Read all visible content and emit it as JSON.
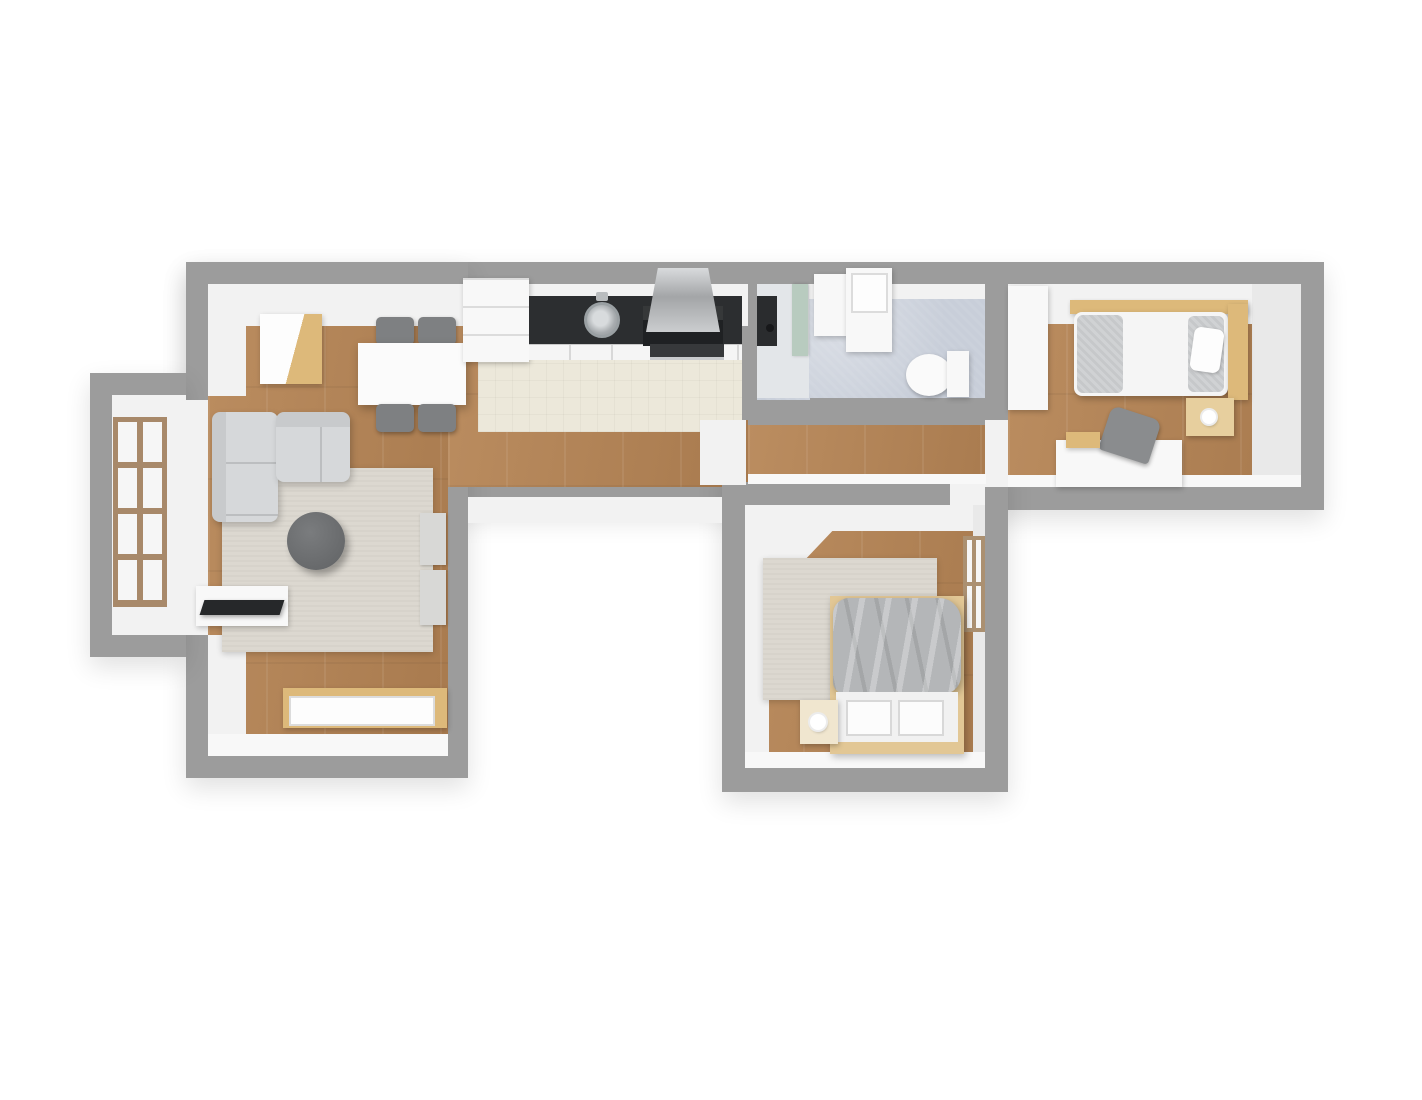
{
  "scene": {
    "description": "3D rendered top-down floor plan of an apartment, no visible text",
    "background": "#ffffff"
  },
  "palette": {
    "wall": "#9c9c9c",
    "wall_face": "#f2f2f2",
    "wood_floor": "#b08256",
    "kitchen_tile": "#ece8da",
    "bathroom_tile": "#c8ced9",
    "rug": "#dcd8d0",
    "sofa": "#d6d8da",
    "accent_wood": "#ddb97a",
    "counter_black": "#2c2e30",
    "blanket_gray": "#b4b6b8"
  },
  "rooms": [
    "living-room",
    "kitchen",
    "bathroom",
    "bedroom-right",
    "bedroom-bottom",
    "balcony-niche",
    "hallway"
  ],
  "elements": [
    {
      "n": "wall-main-bar",
      "c": "wallsh",
      "x": 186,
      "y": 262,
      "w": 1138,
      "h": 248
    },
    {
      "n": "wall-left-wing",
      "c": "wallsh",
      "x": 186,
      "y": 262,
      "w": 282,
      "h": 516
    },
    {
      "n": "wall-balcony-bay",
      "c": "wallsh",
      "x": 90,
      "y": 373,
      "w": 96,
      "h": 284
    },
    {
      "n": "wall-bottom-wing",
      "c": "wallsh",
      "x": 722,
      "y": 460,
      "w": 286,
      "h": 332
    },
    {
      "n": "balcony-floor",
      "c": "face",
      "x": 112,
      "y": 395,
      "w": 74,
      "h": 240
    },
    {
      "n": "balcony-opening",
      "c": "face",
      "x": 186,
      "y": 400,
      "w": 22,
      "h": 235
    },
    {
      "n": "living-room-floor",
      "c": "wood",
      "x": 208,
      "y": 284,
      "w": 240,
      "h": 472
    },
    {
      "n": "living-bar-floor",
      "c": "wood",
      "x": 448,
      "y": 284,
      "w": 300,
      "h": 203
    },
    {
      "n": "hallway-floor",
      "c": "wood",
      "x": 748,
      "y": 425,
      "w": 260,
      "h": 62
    },
    {
      "n": "bedroom-right-floor",
      "c": "wood",
      "x": 1008,
      "y": 284,
      "w": 293,
      "h": 203
    },
    {
      "n": "kitchen-floor",
      "c": "tcream",
      "x": 478,
      "y": 358,
      "w": 264,
      "h": 74
    },
    {
      "n": "bathroom-floor",
      "c": "tbath",
      "x": 757,
      "y": 284,
      "w": 228,
      "h": 116
    },
    {
      "n": "bedroom-bottom-floor",
      "c": "wood",
      "x": 745,
      "y": 505,
      "w": 240,
      "h": 263
    },
    {
      "n": "wall-kitchen-bathroom",
      "c": "wall",
      "x": 742,
      "y": 262,
      "w": 15,
      "h": 158
    },
    {
      "n": "wall-bathroom-bottom",
      "c": "wall",
      "x": 810,
      "y": 398,
      "w": 175,
      "h": 22
    },
    {
      "n": "wall-bathroom-bedroom",
      "c": "wall",
      "x": 985,
      "y": 262,
      "w": 23,
      "h": 140
    },
    {
      "n": "wall-bedroom-bottom-top",
      "c": "wall",
      "x": 722,
      "y": 482,
      "w": 234,
      "h": 23
    },
    {
      "n": "door-bedroom-right",
      "c": "face",
      "x": 985,
      "y": 420,
      "w": 23,
      "h": 67
    },
    {
      "n": "door-bedroom-bottom",
      "c": "face",
      "x": 950,
      "y": 482,
      "w": 35,
      "h": 25
    },
    {
      "n": "door-entry",
      "c": "face",
      "x": 700,
      "y": 420,
      "w": 46,
      "h": 65
    },
    {
      "n": "wallface-top-living-kitchen",
      "c": "face",
      "x": 208,
      "y": 284,
      "w": 540,
      "h": 42
    },
    {
      "n": "wallface-left-living-upper",
      "c": "face",
      "x": 208,
      "y": 284,
      "w": 38,
      "h": 112
    },
    {
      "n": "wallface-left-living-lower",
      "c": "face",
      "x": 208,
      "y": 635,
      "w": 38,
      "h": 121
    },
    {
      "n": "wallface-bottom-living",
      "c": "faceb",
      "x": 208,
      "y": 734,
      "w": 240,
      "h": 22
    },
    {
      "n": "wallface-top-bathroom",
      "c": "face",
      "x": 757,
      "y": 284,
      "w": 228,
      "h": 15
    },
    {
      "n": "wallface-top-bedroom-right",
      "c": "face",
      "x": 1008,
      "y": 284,
      "w": 293,
      "h": 40
    },
    {
      "n": "wallface-right-bedroom-right",
      "c": "faced",
      "x": 1252,
      "y": 284,
      "w": 49,
      "h": 203
    },
    {
      "n": "wallface-bottom-bedroom-right",
      "c": "faceb",
      "x": 1008,
      "y": 475,
      "w": 293,
      "h": 12
    },
    {
      "n": "wallface-void-top",
      "c": "face",
      "x": 468,
      "y": 497,
      "w": 254,
      "h": 26
    },
    {
      "n": "wallface-hallway-bottom",
      "c": "faceb",
      "x": 748,
      "y": 474,
      "w": 238,
      "h": 10
    },
    {
      "n": "wallface-top-bedroom-bottom",
      "c": "face",
      "x": 745,
      "y": 505,
      "w": 240,
      "h": 26
    },
    {
      "n": "wallface-diagonal-bedroom-bottom",
      "c": "face",
      "x": 745,
      "y": 505,
      "w": 112,
      "h": 118,
      "s": "clip-path:polygon(0 0,100% 0,0 100%);"
    },
    {
      "n": "wallface-left-bedroom-bottom",
      "c": "face",
      "x": 745,
      "y": 505,
      "w": 24,
      "h": 263
    },
    {
      "n": "wallface-right-bedroom-bottom",
      "c": "faced",
      "x": 973,
      "y": 505,
      "w": 12,
      "h": 263
    },
    {
      "n": "wallface-bottom-bedroom-bottom",
      "c": "faceb",
      "x": 745,
      "y": 752,
      "w": 240,
      "h": 16
    },
    {
      "n": "living-window",
      "c": "window-grid",
      "x": 113,
      "y": 417,
      "w": 54,
      "h": 190
    },
    {
      "n": "bedroom-bottom-window",
      "c": "window-grid-v",
      "x": 963,
      "y": 536,
      "w": 22,
      "h": 96
    },
    {
      "n": "living-cabinet",
      "c": "tan",
      "x": 260,
      "y": 314,
      "w": 62,
      "h": 70,
      "s": "background:linear-gradient(105deg,#fdfdfd 0 55%,#ddb97a 55% 100%);"
    },
    {
      "n": "dining-chair-top-left",
      "c": "chair",
      "x": 376,
      "y": 317,
      "w": 38,
      "h": 28
    },
    {
      "n": "dining-chair-top-right",
      "c": "chair",
      "x": 418,
      "y": 317,
      "w": 38,
      "h": 28
    },
    {
      "n": "dining-table",
      "c": "twhite",
      "x": 358,
      "y": 343,
      "w": 108,
      "h": 62
    },
    {
      "n": "dining-chair-bottom-left",
      "c": "chair",
      "x": 376,
      "y": 404,
      "w": 38,
      "h": 28
    },
    {
      "n": "dining-chair-bottom-right",
      "c": "chair",
      "x": 418,
      "y": 404,
      "w": 38,
      "h": 28
    },
    {
      "n": "living-rug",
      "c": "rug",
      "x": 222,
      "y": 468,
      "w": 211,
      "h": 184
    },
    {
      "n": "sofa-chaise",
      "c": "sofa-v",
      "x": 212,
      "y": 412,
      "w": 66,
      "h": 110
    },
    {
      "n": "sofa-main",
      "c": "sofa-h",
      "x": 276,
      "y": 412,
      "w": 74,
      "h": 70
    },
    {
      "n": "coffee-table",
      "c": "ctable",
      "x": 287,
      "y": 512,
      "w": 58,
      "h": 58
    },
    {
      "n": "radiator-upper",
      "c": "radiator",
      "x": 420,
      "y": 513,
      "w": 26,
      "h": 52
    },
    {
      "n": "radiator-lower",
      "c": "radiator",
      "x": 420,
      "y": 570,
      "w": 26,
      "h": 55
    },
    {
      "n": "tv-stand",
      "c": "white",
      "x": 196,
      "y": 586,
      "w": 92,
      "h": 40
    },
    {
      "n": "tv-screen",
      "c": "tv",
      "x": 202,
      "y": 600,
      "w": 80,
      "h": 15,
      "s": "transform:skewX(-18deg);"
    },
    {
      "n": "sideboard",
      "c": "tan",
      "x": 283,
      "y": 688,
      "w": 164,
      "h": 40
    },
    {
      "n": "sideboard-front",
      "c": "basin",
      "x": 289,
      "y": 696,
      "w": 146,
      "h": 30
    },
    {
      "n": "kitchen-tall-unit",
      "c": "white",
      "x": 463,
      "y": 278,
      "w": 66,
      "h": 84,
      "s": "background-image:repeating-linear-gradient(0deg,rgba(0,0,0,0) 0 26px,#dcdcdc 26px 28px);"
    },
    {
      "n": "kitchen-counter",
      "c": "counter",
      "x": 529,
      "y": 296,
      "w": 213,
      "h": 48
    },
    {
      "n": "kitchen-cabinet-front",
      "c": "cabfront",
      "x": 529,
      "y": 344,
      "w": 213,
      "h": 16
    },
    {
      "n": "kitchen-sink",
      "c": "sink",
      "x": 584,
      "y": 302,
      "w": 36,
      "h": 36
    },
    {
      "n": "kitchen-faucet",
      "c": "faucet",
      "x": 596,
      "y": 292,
      "w": 12,
      "h": 9
    },
    {
      "n": "kitchen-cooktop",
      "c": "cooktop",
      "x": 643,
      "y": 306,
      "w": 80,
      "h": 40
    },
    {
      "n": "kitchen-oven",
      "c": "oven",
      "x": 650,
      "y": 344,
      "w": 74,
      "h": 16
    },
    {
      "n": "kitchen-hood",
      "c": "hood",
      "x": 646,
      "y": 268,
      "w": 74,
      "h": 64
    },
    {
      "n": "shower-floor",
      "c": "face",
      "x": 757,
      "y": 284,
      "w": 52,
      "h": 114,
      "s": "background:#e3e6e9;"
    },
    {
      "n": "shower-panel",
      "c": "dark",
      "x": 757,
      "y": 296,
      "w": 20,
      "h": 50
    },
    {
      "n": "shower-drain",
      "c": "drain",
      "x": 766,
      "y": 324,
      "w": 8,
      "h": 8
    },
    {
      "n": "shower-glass",
      "c": "glass",
      "x": 792,
      "y": 284,
      "w": 16,
      "h": 72
    },
    {
      "n": "washing-machine",
      "c": "white",
      "x": 814,
      "y": 274,
      "w": 34,
      "h": 62
    },
    {
      "n": "bathroom-sink-unit",
      "c": "white",
      "x": 846,
      "y": 268,
      "w": 46,
      "h": 84
    },
    {
      "n": "bathroom-basin",
      "c": "basin",
      "x": 851,
      "y": 273,
      "w": 37,
      "h": 40
    },
    {
      "n": "toilet-bowl",
      "c": "bowl",
      "x": 906,
      "y": 354,
      "w": 46,
      "h": 42
    },
    {
      "n": "toilet-tank",
      "c": "white",
      "x": 947,
      "y": 351,
      "w": 22,
      "h": 46
    },
    {
      "n": "wardrobe",
      "c": "white",
      "x": 1008,
      "y": 286,
      "w": 40,
      "h": 124
    },
    {
      "n": "bed-right-rail",
      "c": "tan",
      "x": 1070,
      "y": 300,
      "w": 178,
      "h": 14
    },
    {
      "n": "bed-right-mattress",
      "c": "mattress",
      "x": 1074,
      "y": 312,
      "w": 154,
      "h": 84
    },
    {
      "n": "bed-right-folded-blanket",
      "c": "pillow-g",
      "x": 1077,
      "y": 315,
      "w": 46,
      "h": 78
    },
    {
      "n": "bed-right-pillow-gray",
      "c": "pillow-g",
      "x": 1188,
      "y": 316,
      "w": 36,
      "h": 76
    },
    {
      "n": "bed-right-pillow-white",
      "c": "pillow-w",
      "x": 1192,
      "y": 328,
      "w": 30,
      "h": 44,
      "s": "transform:rotate(8deg);"
    },
    {
      "n": "bed-right-headboard",
      "c": "tan",
      "x": 1228,
      "y": 304,
      "w": 20,
      "h": 96
    },
    {
      "n": "nightstand-right",
      "c": "nstand",
      "x": 1186,
      "y": 398,
      "w": 48,
      "h": 38
    },
    {
      "n": "nightstand-right-lamp",
      "c": "lamp",
      "x": 1202,
      "y": 410,
      "w": 14,
      "h": 14
    },
    {
      "n": "desk",
      "c": "white",
      "x": 1056,
      "y": 440,
      "w": 126,
      "h": 47
    },
    {
      "n": "desk-chair",
      "c": "deskchair",
      "x": 1104,
      "y": 412,
      "w": 52,
      "h": 46,
      "s": "transform:rotate(18deg);"
    },
    {
      "n": "desk-box",
      "c": "tan",
      "x": 1066,
      "y": 432,
      "w": 34,
      "h": 16
    },
    {
      "n": "bedroom-bottom-rug",
      "c": "rug",
      "x": 763,
      "y": 558,
      "w": 174,
      "h": 142
    },
    {
      "n": "bed-bottom-frame",
      "c": "bedbase",
      "x": 830,
      "y": 596,
      "w": 134,
      "h": 158,
      "s": "box-shadow:2px 3px 7px rgba(0,0,0,.25);"
    },
    {
      "n": "bed-bottom-blanket",
      "c": "blanket",
      "x": 833,
      "y": 598,
      "w": 128,
      "h": 96
    },
    {
      "n": "bed-bottom-footboard",
      "c": "footboard",
      "x": 836,
      "y": 692,
      "w": 122,
      "h": 50
    },
    {
      "n": "bed-bottom-panel-left",
      "c": "panel",
      "x": 846,
      "y": 700,
      "w": 46,
      "h": 36
    },
    {
      "n": "bed-bottom-panel-right",
      "c": "panel",
      "x": 898,
      "y": 700,
      "w": 46,
      "h": 36
    },
    {
      "n": "bed-bottom-base",
      "c": "bedbase",
      "x": 833,
      "y": 744,
      "w": 128,
      "h": 10
    },
    {
      "n": "nightstand-bottom",
      "c": "nstand",
      "x": 800,
      "y": 700,
      "w": 38,
      "h": 44,
      "s": "background:#f0e6cf;"
    },
    {
      "n": "nightstand-bottom-lamp",
      "c": "lamp",
      "x": 810,
      "y": 714,
      "w": 16,
      "h": 16
    }
  ]
}
